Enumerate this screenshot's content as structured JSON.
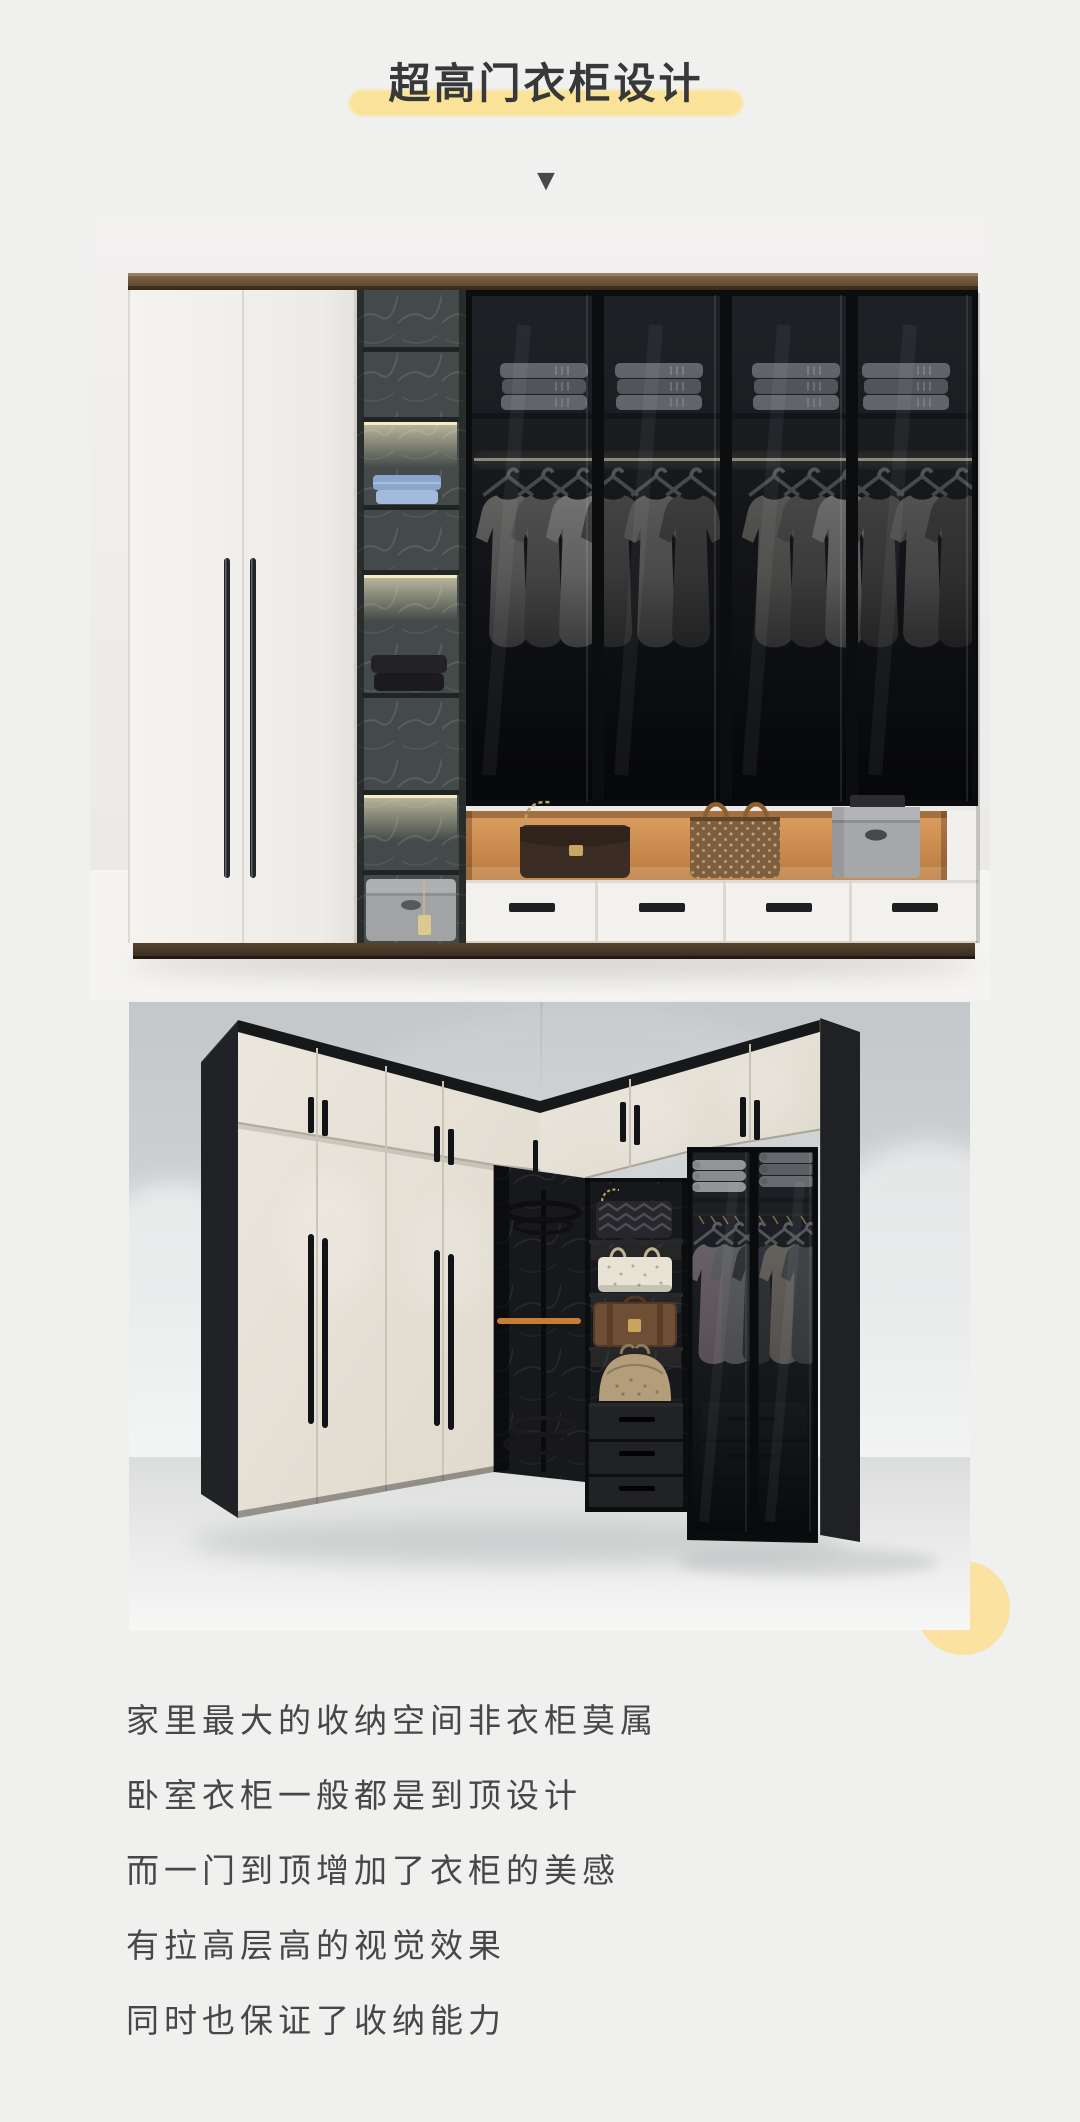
{
  "page": {
    "width": 1080,
    "height": 2122,
    "background_color": "#f0f0ee"
  },
  "header": {
    "title": "超高门衣柜设计",
    "title_color": "#36383a",
    "highlight_color": "#fae398",
    "arrow_glyph": "▼",
    "arrow_color": "#47494b"
  },
  "photos": {
    "photo1_alt": "tall white and smoked-glass wardrobe with lit marble shelves, orange display niche with handbags and white drawers",
    "photo2_alt": "L-shaped corner wardrobe with cream doors, long black handles, dark corner rack unit, handbag shelves and glass doors"
  },
  "decor": {
    "corner_circle_color": "#fbe2a0"
  },
  "article": {
    "text_color": "#47474a",
    "paragraphs": [
      "家里最大的收纳空间非衣柜莫属",
      "卧室衣柜一般都是到顶设计",
      "而一门到顶增加了衣柜的美感",
      "有拉高层高的视觉效果",
      "同时也保证了收纳能力"
    ]
  }
}
